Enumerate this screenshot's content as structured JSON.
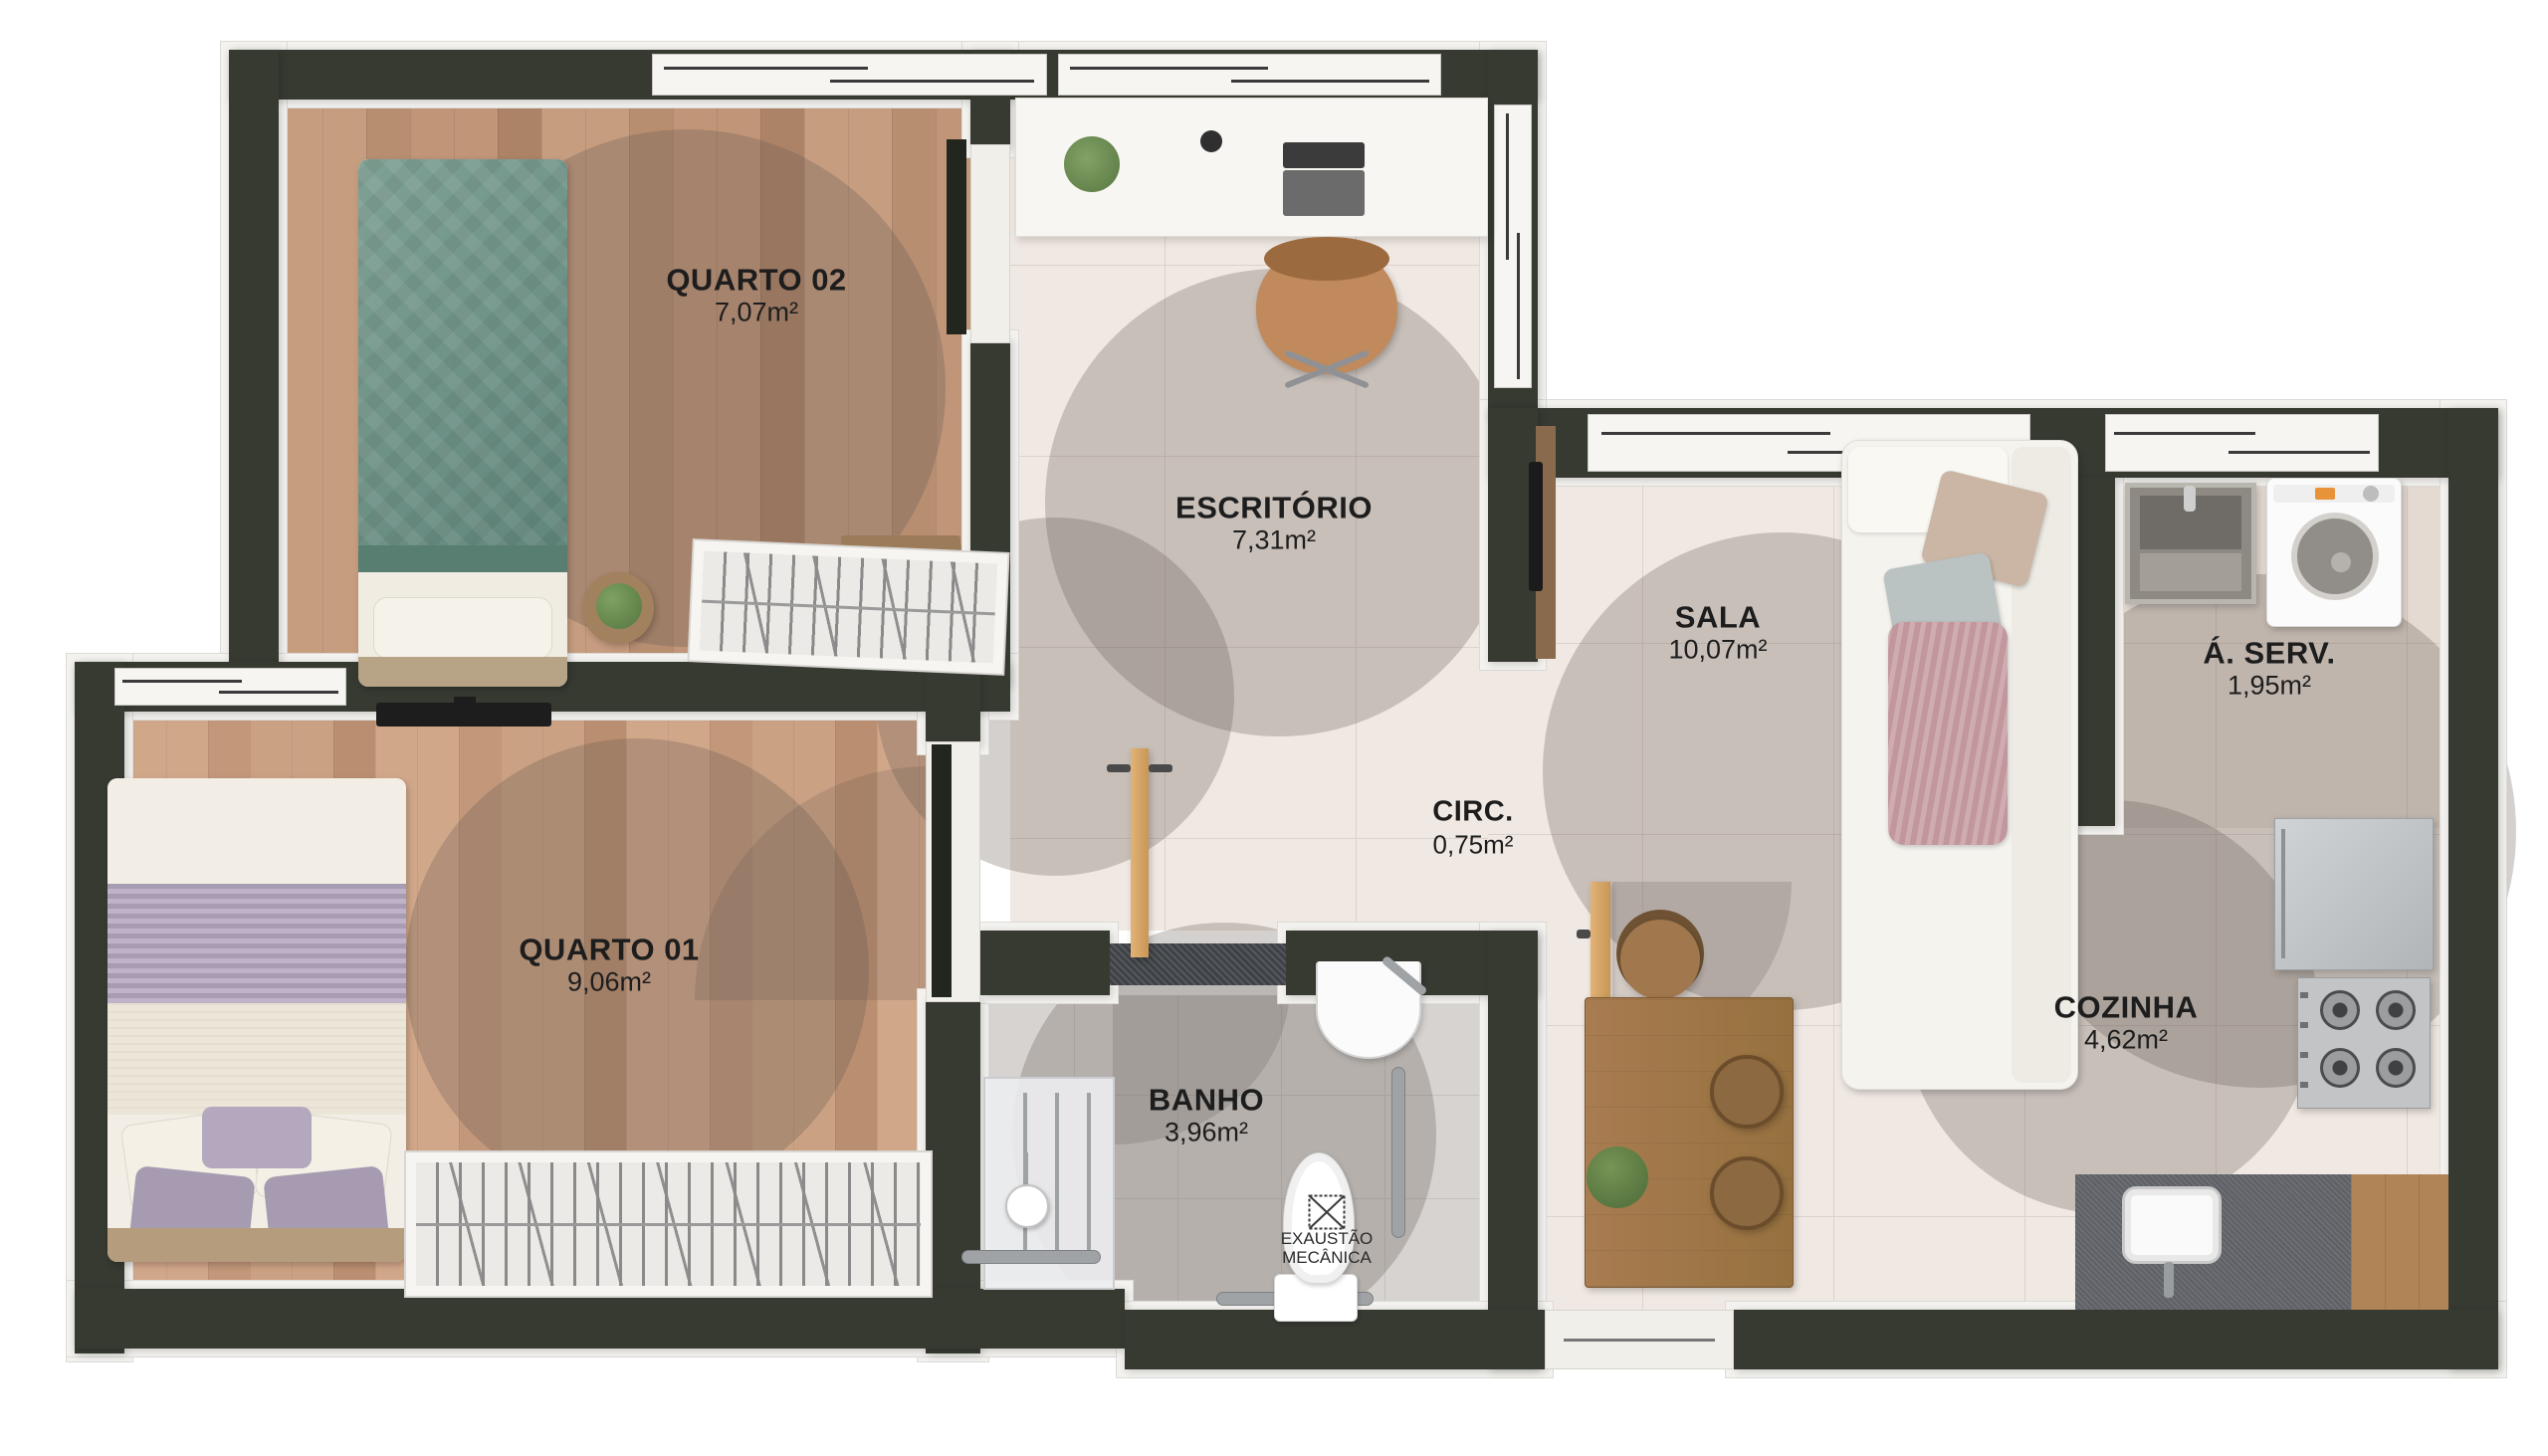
{
  "title": "Planta baixa humanizada",
  "rooms": [
    {
      "id": "quarto-02",
      "name": "QUARTO 02",
      "area": "7,07m²"
    },
    {
      "id": "escritorio",
      "name": "ESCRITÓRIO",
      "area": "7,31m²"
    },
    {
      "id": "sala",
      "name": "SALA",
      "area": "10,07m²"
    },
    {
      "id": "area-servico",
      "name": "Á. SERV.",
      "area": "1,95m²"
    },
    {
      "id": "circulacao",
      "name": "CIRC.",
      "area": "0,75m²"
    },
    {
      "id": "quarto-01",
      "name": "QUARTO 01",
      "area": "9,06m²"
    },
    {
      "id": "banho",
      "name": "BANHO",
      "area": "3,96m²"
    },
    {
      "id": "cozinha",
      "name": "COZINHA",
      "area": "4,62m²"
    }
  ],
  "annotations": {
    "exhaust_line1": "EXAUSTÃO",
    "exhaust_line2": "MECÂNICA"
  },
  "colors": {
    "wall": "#363a31",
    "trim": "#f3f2ef",
    "tile": "#f0e8e2",
    "bath_tile": "#d6d3d0",
    "wood_dark": "#bc9175",
    "wood_light": "#c9a084",
    "highlight_tint": "rgba(96,87,78,0.28)",
    "door_wood": "#d9a96e",
    "bed_green": "#7da094",
    "bed_purple": "#a89cb3"
  }
}
